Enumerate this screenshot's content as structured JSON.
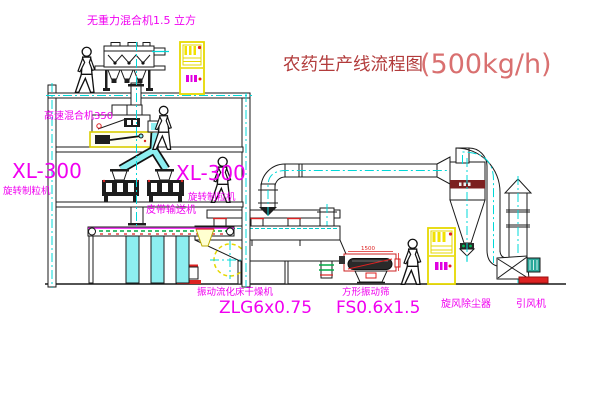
{
  "title": {
    "name": "农药生产线流程图",
    "capacity": "(500kg/h)"
  },
  "labels": {
    "gravity_mixer": "无重力混合机1.5 立方",
    "high_speed_mixer": "高速混合机350",
    "granulator_model_left": "XL-300",
    "granulator_name_left": "旋转制粒机",
    "granulator_model_right": "XL-300",
    "granulator_name_right": "旋转制粒机",
    "belt_conveyor": "皮带输送机",
    "dryer_name": "振动流化床干燥机",
    "dryer_model": "ZLG6x0.75",
    "screen_name": "方形振动筛",
    "screen_model": "FS0.6x1.5",
    "screen_dim": "1500",
    "cyclone": "旋风除尘器",
    "fan": "引风机"
  },
  "colors": {
    "label_magenta": "#f000f0",
    "title_chinese": "#b23b3b",
    "title_capacity": "#d97070",
    "centerline_cyan": "#00d8d8",
    "pipe_cyan": "#8deef0",
    "cabinet_yellow": "#e6d800",
    "accent_red": "#dd2222",
    "accent_green": "#00a844",
    "line_black": "#1a1a1a"
  }
}
